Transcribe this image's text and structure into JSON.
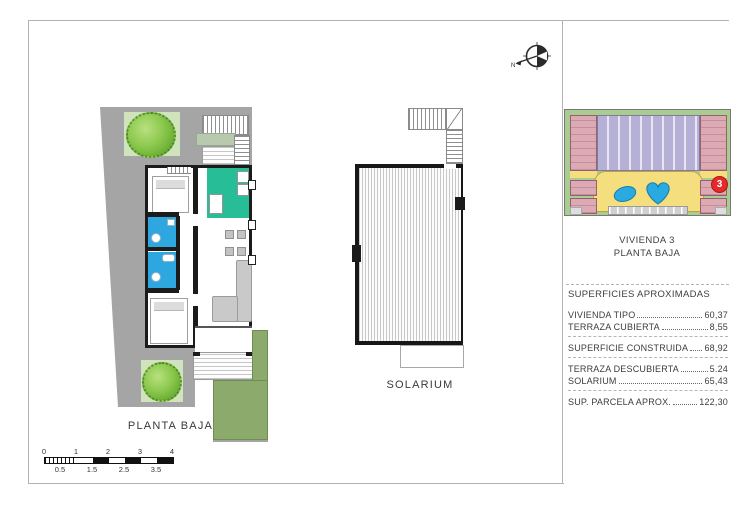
{
  "compass": {
    "north_label": "N"
  },
  "plans": {
    "floor_plan_label": "PLANTA BAJA",
    "solarium_label": "SOLARIUM"
  },
  "scale_bar": {
    "major_labels": [
      "0",
      "1",
      "2",
      "3",
      "4"
    ],
    "minor_labels": [
      "0.5",
      "1.5",
      "2.5",
      "3.5"
    ]
  },
  "site_plan": {
    "unit_badge": "3"
  },
  "info_panel": {
    "unit_title": "VIVIENDA 3",
    "floor_title": "PLANTA BAJA",
    "section_header": "SUPERFICIES APROXIMADAS",
    "rows": [
      {
        "label": "VIVIENDA TIPO",
        "value": "60,37"
      },
      {
        "label": "TERRAZA CUBIERTA",
        "value": "8,55"
      },
      {
        "label": "SUPERFICIE CONSTRUIDA",
        "value": "68,92"
      },
      {
        "label": "TERRAZA DESCUBIERTA",
        "value": "5.24"
      },
      {
        "label": "SOLARIUM",
        "value": "65,43"
      },
      {
        "label": "SUP. PARCELA APROX.",
        "value": "122,30"
      }
    ]
  },
  "colors": {
    "wall_black": "#1b1b1b",
    "terrace_gray": "#a5a5a5",
    "kitchen_teal": "#27bd96",
    "bathroom_blue": "#2ea7e0",
    "tree_green": "#7cbe3e",
    "lawn_green": "#8baa6c",
    "pool_blue": "#29abe2",
    "courtyard_yellow": "#f4de7e",
    "building_pink": "#dcaab5",
    "building_purple": "#b5b0d6",
    "badge_red": "#e62a2a"
  }
}
